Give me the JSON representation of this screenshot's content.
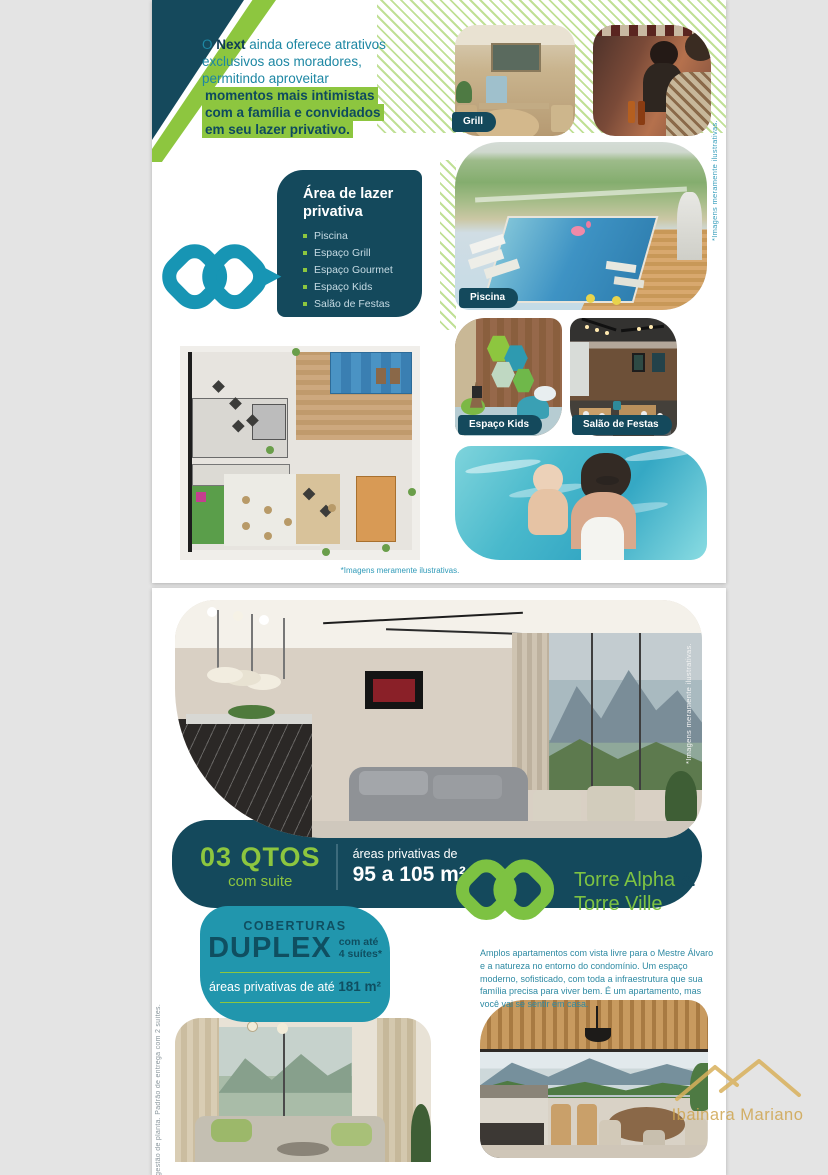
{
  "page1": {
    "intro": {
      "t1": "O ",
      "brand": "Next",
      "t2": " ainda oferece atrativos exclusivos aos moradores, permitindo aproveitar ",
      "highlight": "momentos mais intimistas com a família e convidados em seu lazer privativo."
    },
    "leisure": {
      "title": "Área de lazer privativa",
      "items": [
        "Piscina",
        "Espaço Grill",
        "Espaço Gourmet",
        "Espaço Kids",
        "Salão de Festas"
      ]
    },
    "photo_labels": {
      "grill": "Grill",
      "pool": "Piscina",
      "kids": "Espaço Kids",
      "party": "Salão de Festas"
    },
    "side_note": "*Imagens meramente ilustrativas.",
    "caption": "*Imagens meramente ilustrativas."
  },
  "page2": {
    "photo_note": "*Imagens meramente ilustrativas.",
    "qtos": {
      "qty": "03 QTOS",
      "suite": "com suite",
      "area_label": "áreas privativas de",
      "area_value": "95 a 105 m²"
    },
    "duplex": {
      "kicker": "COBERTURAS",
      "title": "DUPLEX",
      "sub1": "com até",
      "sub2": "4 suítes*",
      "area_label": "áreas privativas de até ",
      "area_value": "181 m²"
    },
    "plan_note": "*Sugestão de planta. Padrão de entrega com 2 suítes.",
    "towers": {
      "line1": "Torre Alpha ",
      "amp": "&",
      "line2": "Torre Ville"
    },
    "description": "Amplos apartamentos com vista livre para o Mestre Álvaro e a natureza no entorno do condomínio. Um espaço moderno, sofisticado, com toda a infraestrutura que sua família precisa para viver bem. É um apartamento, mas você vai se sentir em casa."
  },
  "watermark": {
    "name": "Ibainara Mariano"
  },
  "colors": {
    "dark_teal": "#14495c",
    "teal": "#1f96b2",
    "green": "#8dc63f",
    "gold": "#cfa54f"
  }
}
